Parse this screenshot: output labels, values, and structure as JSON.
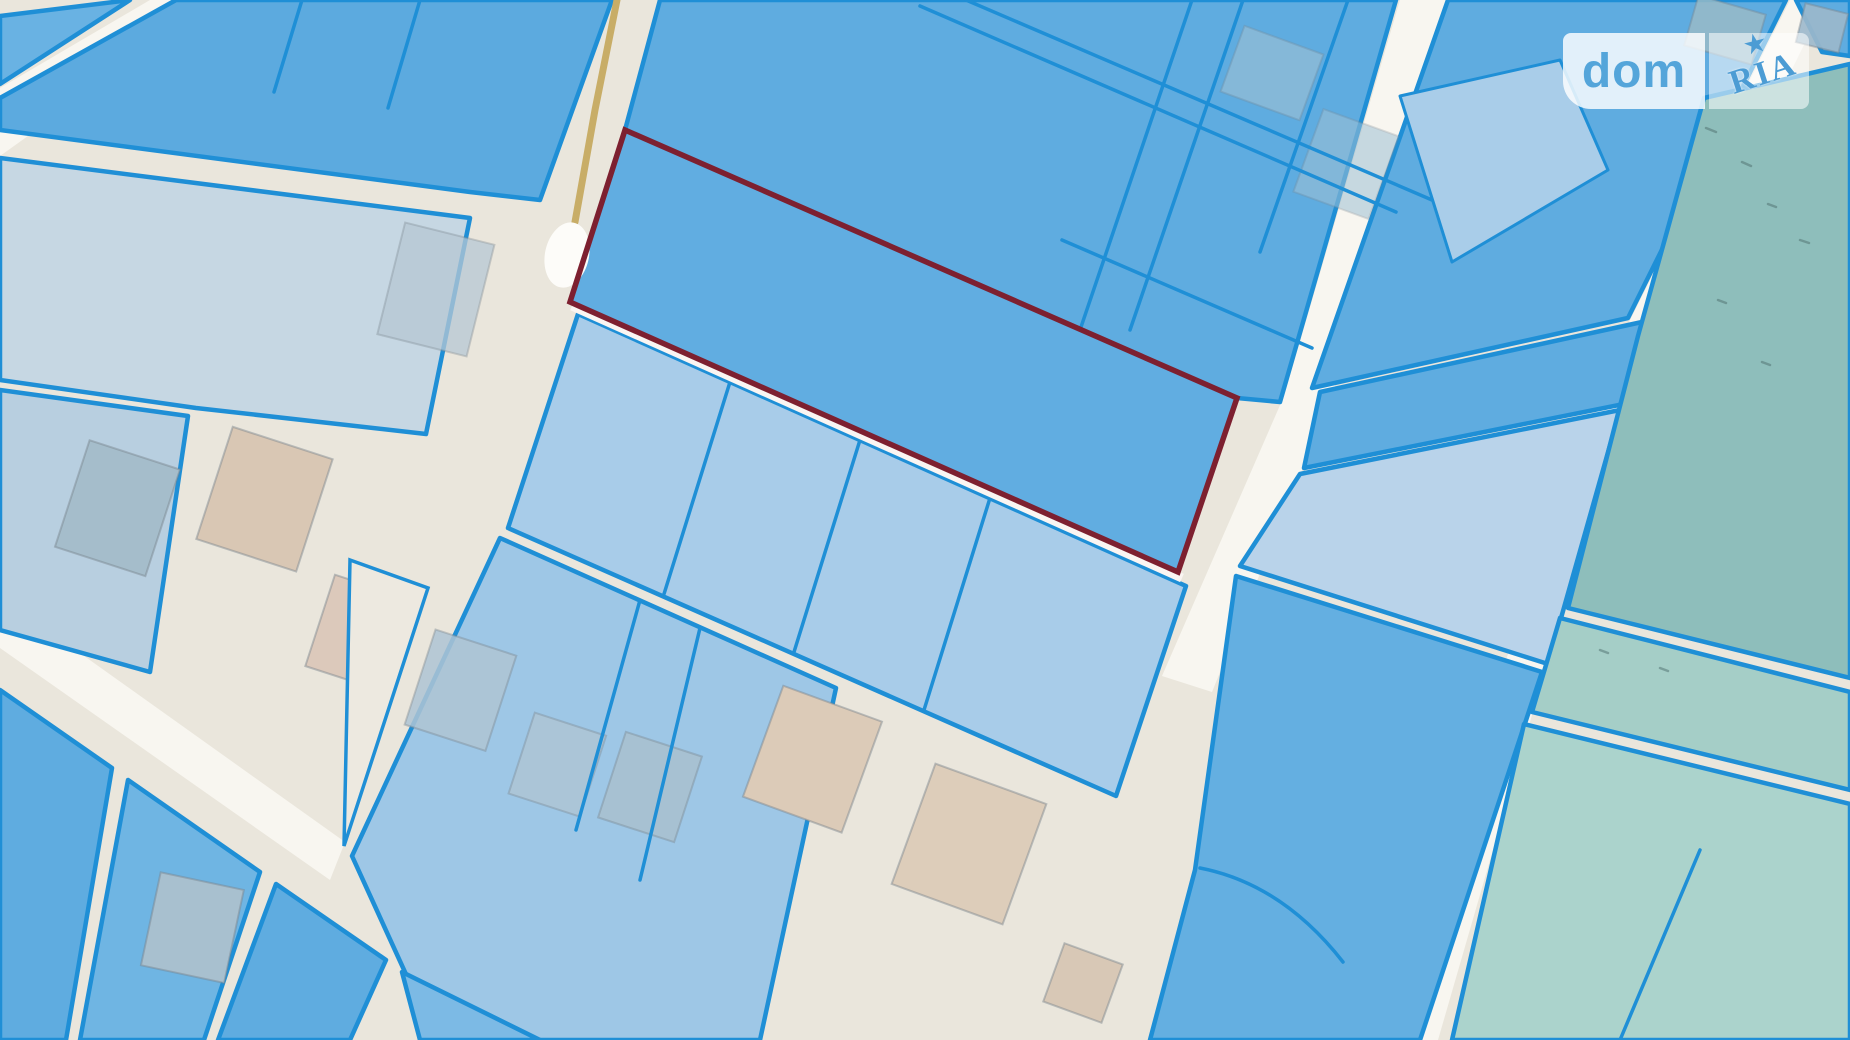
{
  "watermark": {
    "brand_left": "dom",
    "brand_right": "RIA",
    "star_icon": "★"
  },
  "map": {
    "type": "cadastral-parcel-map",
    "description": "Satellite-style cadastral map of land parcels; one parcel is outlined in dark red as the highlighted listing plot",
    "palette": {
      "parcel_blue_medium": "#5FACE0",
      "parcel_blue_light": "#A8CCE9",
      "parcel_pale_gray_blue": "#C6D7E3",
      "parcel_teal": "#A5CEC7",
      "parcel_teal_dark": "#8EBEBB",
      "parcel_stroke_blue": "#1F8FD6",
      "highlight_red": "#7D2030",
      "road_ground": "#EAE6DC",
      "road_white": "#F8F6F0",
      "building_tan": "#DCCBB8",
      "building_gray": "#A5BDCB",
      "path_olive": "#C8AD67"
    },
    "highlighted_parcel": {
      "outline_color": "#7D2030",
      "fill_color": "#61ADE1"
    }
  }
}
